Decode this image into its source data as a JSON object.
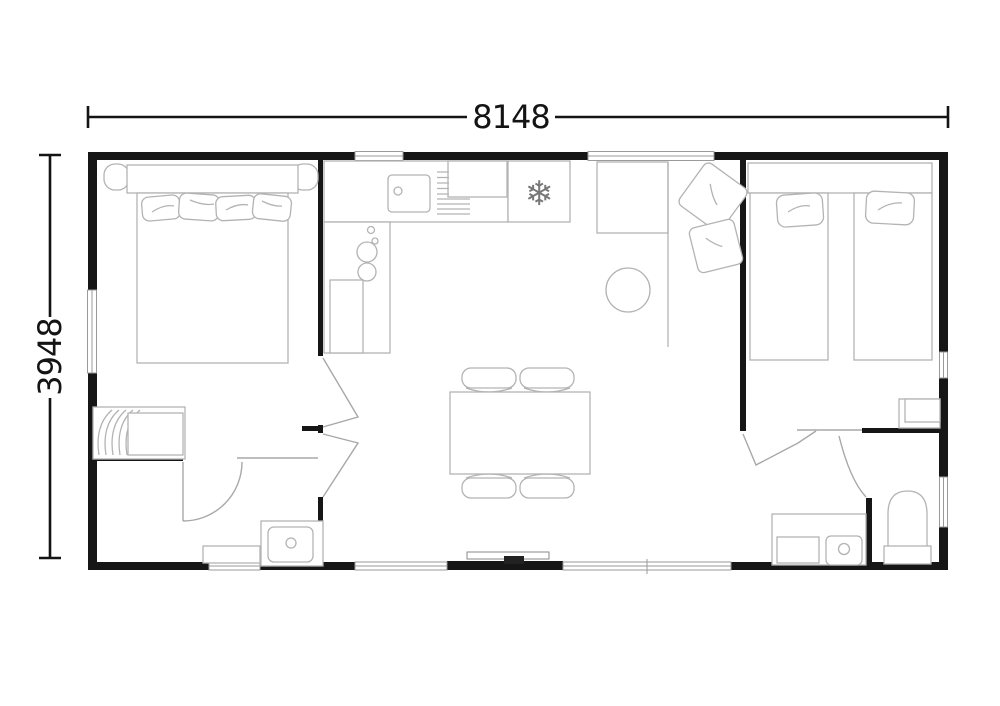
{
  "page": {
    "background": "#ffffff"
  },
  "dimensions": {
    "width_label": "8148",
    "height_label": "3948"
  },
  "colors": {
    "wall": "#161616",
    "dimension_line": "#141414",
    "furniture_line": "#b3b3b3",
    "door_line": "#a8a8a8",
    "background": "#ffffff"
  },
  "icons": {
    "freezer_glyph": "❄"
  }
}
